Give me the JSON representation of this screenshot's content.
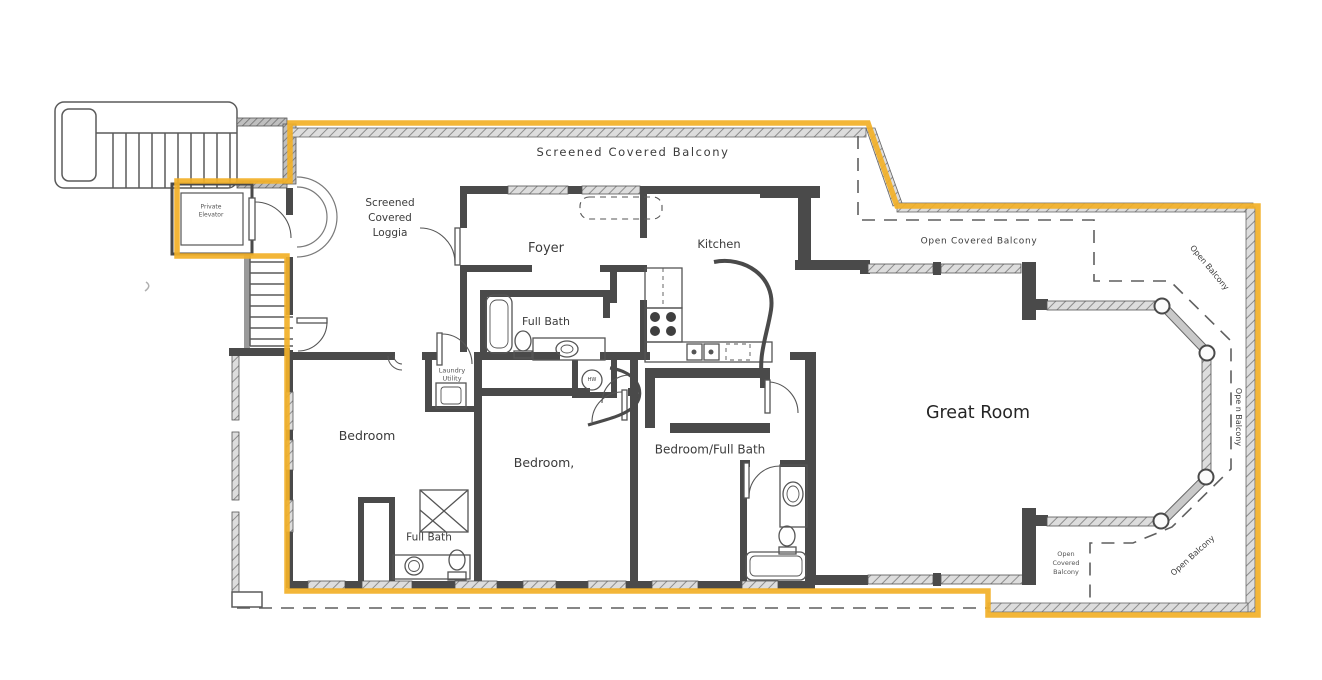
{
  "plan": {
    "colors": {
      "boundary": "#F2B029",
      "wall": "#4a4a4a",
      "paper": "#ffffff",
      "dash": "#5f5f5f"
    },
    "labels": {
      "screened_covered_balcony": {
        "text": "Screened  Covered  Balcony"
      },
      "screened_covered_loggia": {
        "text": "Screened\nCovered\nLoggia"
      },
      "private_elevator": {
        "text": "Private\nElevator"
      },
      "foyer": {
        "text": "Foyer"
      },
      "kitchen": {
        "text": "Kitchen"
      },
      "open_covered_balcony_top": {
        "text": "Open Covered  Balcony"
      },
      "open_balcony_top_right": {
        "text": "Open Balcony"
      },
      "open_balcony_right": {
        "text": "Ope n Balcony"
      },
      "great_room": {
        "text": "Great Room"
      },
      "full_bath_upper": {
        "text": "Full Bath"
      },
      "laundry_utility": {
        "text": "Laundry\nUtility"
      },
      "hw": {
        "text": "HW"
      },
      "bedroom_left": {
        "text": "Bedroom"
      },
      "bedroom_middle": {
        "text": "Bedroom,"
      },
      "bedroom_full_bath": {
        "text": "Bedroom/Full Bath"
      },
      "full_bath_lower": {
        "text": "Full Bath"
      },
      "open_covered_balcony_bottom": {
        "text": "Open\nCovered\nBalcony"
      },
      "open_balcony_bottom_right": {
        "text": "Open Balcony"
      }
    }
  }
}
